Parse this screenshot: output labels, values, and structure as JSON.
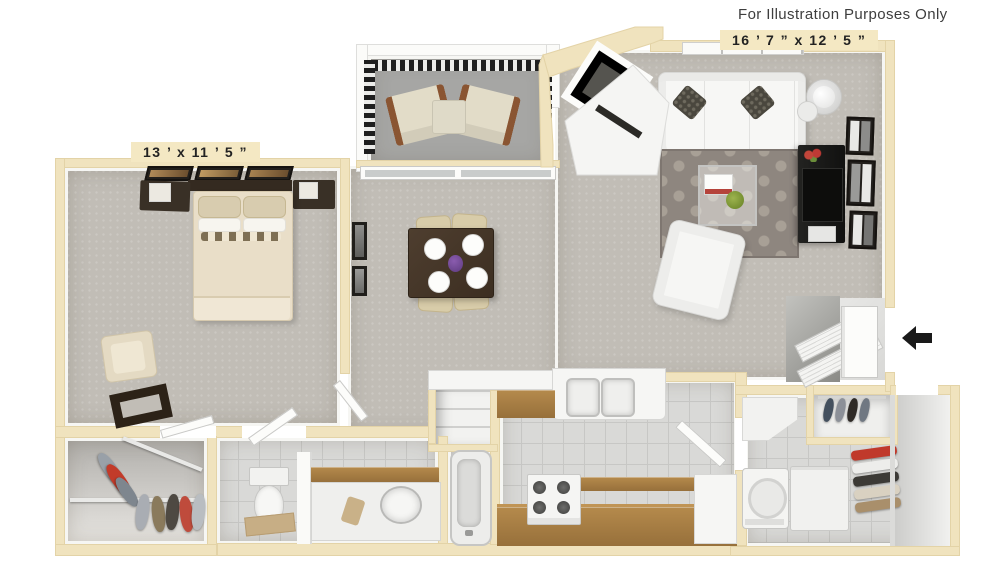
{
  "page": {
    "disclaimer": "For Illustration Purposes Only"
  },
  "labels": {
    "living_room_dims": "16 ’ 7 ”  x  12 ’ 5 ”",
    "bedroom_dims": "13 ’  x  11 ’ 5 ”"
  },
  "icons": {
    "entry_arrow": "arrow-left-solid"
  },
  "colors": {
    "wall": "#F0E3BE",
    "wall_edge": "#E3D3A7",
    "carpet": "#C1BDB6",
    "tile": "#D9D9D7",
    "tile_line": "#C7C7C5",
    "balcony_floor": "#A6A6A4",
    "wood": "#A37C42",
    "dark_wood": "#393026",
    "rug": "#8E867F",
    "rug_dot": "#A8A096",
    "label_bg": "#F4E8C3",
    "text": "#3E3E3E",
    "arrow": "#1A1A1A",
    "red_accent": "#C0392B",
    "plant_green": "#86A23A",
    "centerpiece_purple": "#7A4E9E"
  }
}
